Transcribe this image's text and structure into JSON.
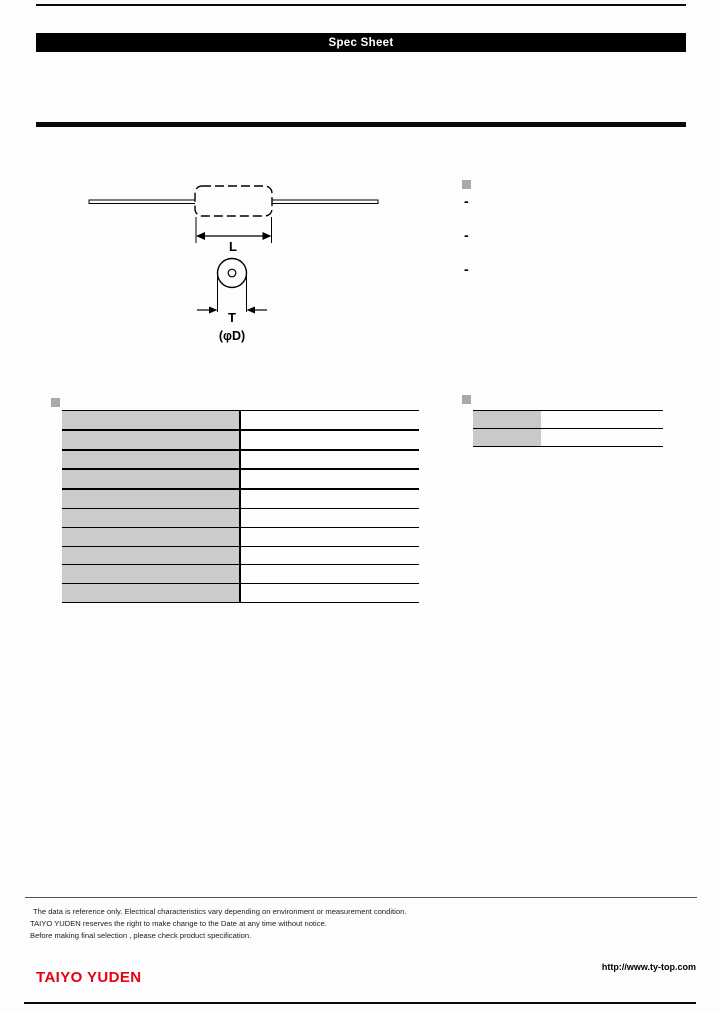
{
  "header": {
    "title": "Spec Sheet"
  },
  "diagram": {
    "length_label": "L",
    "thickness_label": "T",
    "diameter_label": "(φD)"
  },
  "features": {
    "bullet_items": [
      "-",
      "-",
      "-"
    ]
  },
  "spec_table": {
    "row_count": 10,
    "thick_separator_rows": 4
  },
  "summary_table": {
    "row_count": 2
  },
  "icons": {
    "section_bullet": "gray-square-bullet"
  },
  "colors": {
    "accent_red": "#e60012",
    "table_cell_gray": "#cbcbcb",
    "bullet_gray": "#a9a9a9"
  },
  "footer": {
    "disclaimer_lines": [
      "The data is reference only. Electrical characteristics vary depending on environment or measurement condition.",
      "TAIYO YUDEN reserves the right to make change to the Date at any time without notice.",
      "Before making final selection , please check product specification."
    ],
    "logo_text": "TAIYO YUDEN",
    "url": "http://www.ty-top.com"
  }
}
